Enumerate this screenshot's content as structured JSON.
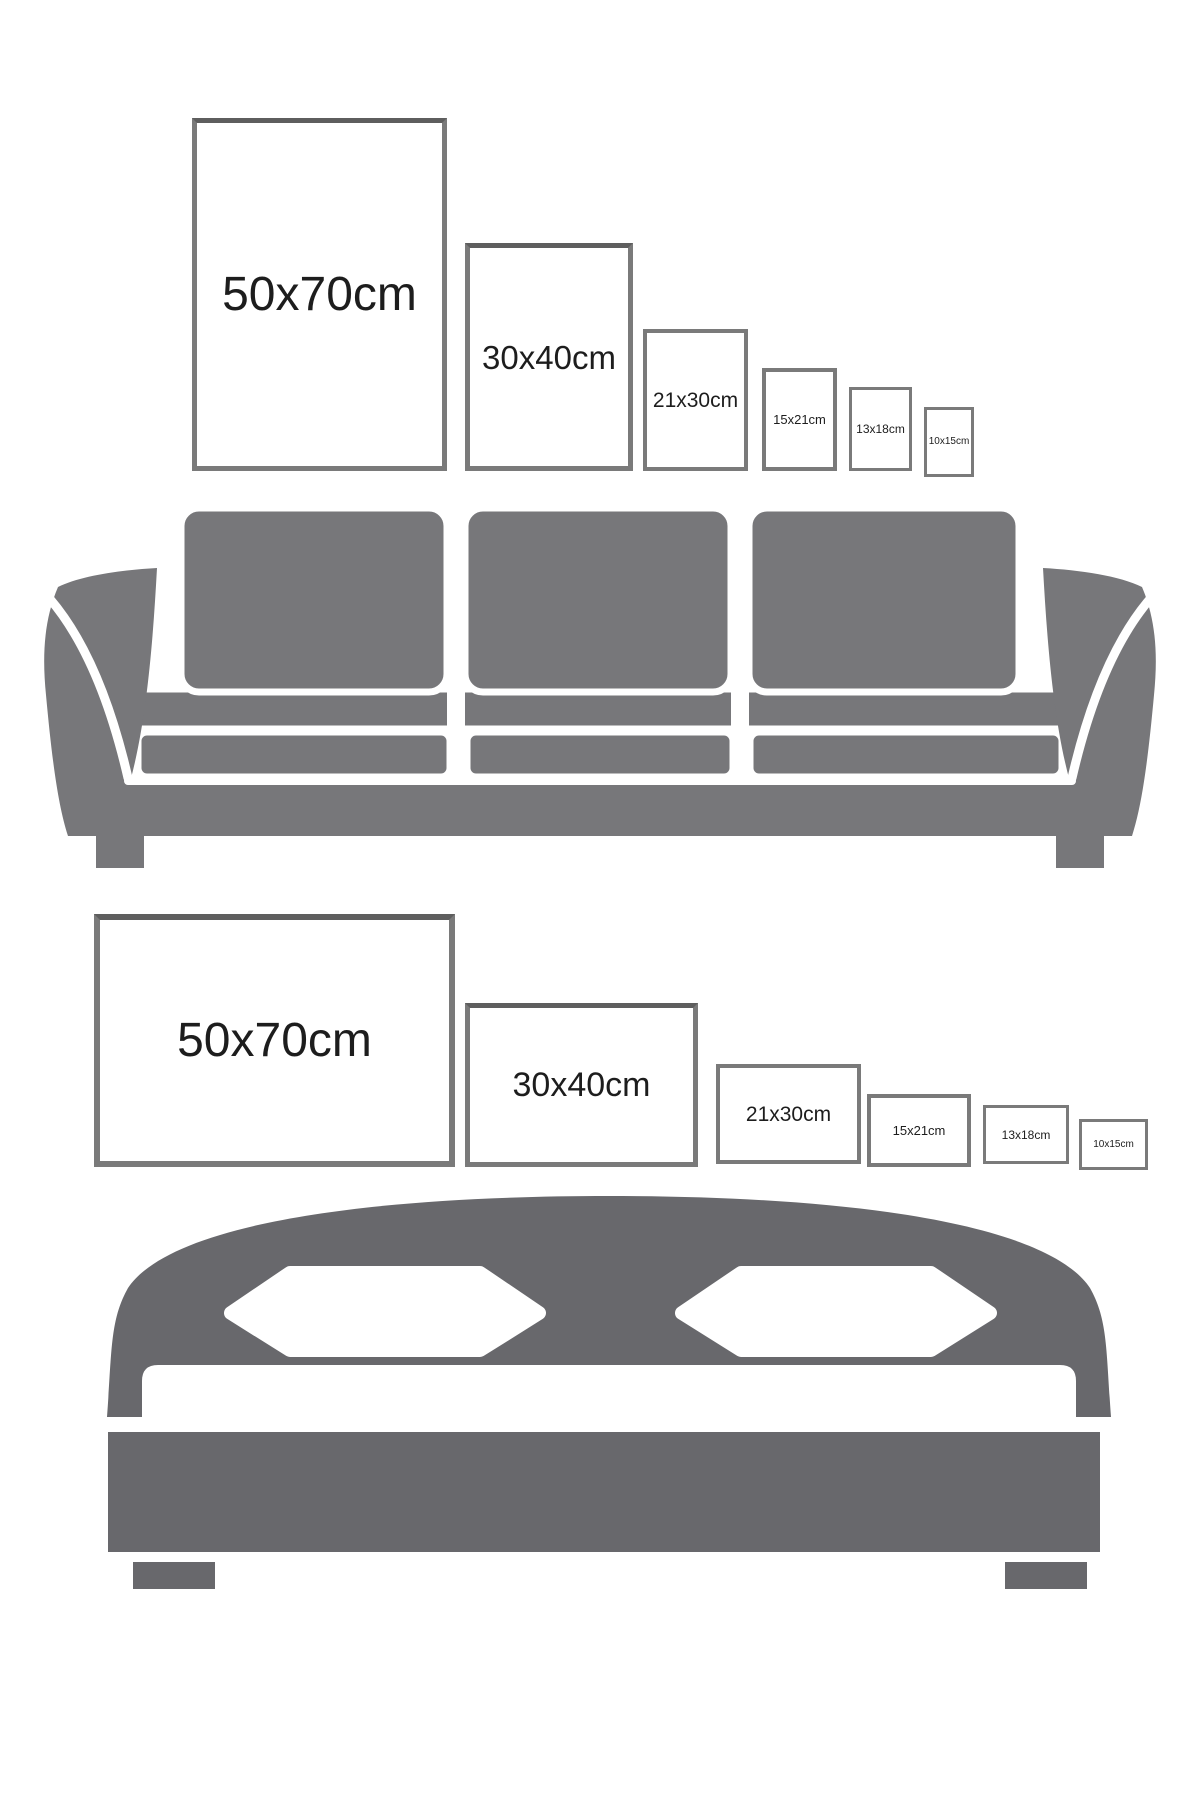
{
  "page": {
    "background": "#ffffff",
    "width": 1200,
    "height": 1800
  },
  "colors": {
    "frame_border": "#7a7a7a",
    "frame_border_top_large": "#5e5e5e",
    "label_text": "#1d1d1d",
    "sofa_gray": "#77777a",
    "bed_gray": "#68686c",
    "separator_white": "#ffffff"
  },
  "portrait_row": {
    "description": "portrait poster sizes above sofa",
    "frames": [
      {
        "id": "50x70-portrait",
        "label": "50x70cm",
        "x": 192,
        "y": 118,
        "w": 255,
        "h": 353,
        "border_px": 5,
        "font_px": 48,
        "dark_top": true
      },
      {
        "id": "30x40-portrait",
        "label": "30x40cm",
        "x": 465,
        "y": 243,
        "w": 168,
        "h": 228,
        "border_px": 5,
        "font_px": 33,
        "dark_top": true
      },
      {
        "id": "21x30-portrait",
        "label": "21x30cm",
        "x": 643,
        "y": 329,
        "w": 105,
        "h": 142,
        "border_px": 4,
        "font_px": 21,
        "dark_top": false
      },
      {
        "id": "15x21-portrait",
        "label": "15x21cm",
        "x": 762,
        "y": 368,
        "w": 75,
        "h": 103,
        "border_px": 4,
        "font_px": 13,
        "dark_top": false
      },
      {
        "id": "13x18-portrait",
        "label": "13x18cm",
        "x": 849,
        "y": 387,
        "w": 63,
        "h": 84,
        "border_px": 3,
        "font_px": 12,
        "dark_top": false
      },
      {
        "id": "10x15-portrait",
        "label": "10x15cm",
        "x": 924,
        "y": 407,
        "w": 50,
        "h": 70,
        "border_px": 3,
        "font_px": 10,
        "dark_top": false
      }
    ]
  },
  "landscape_row": {
    "description": "landscape poster sizes above bed",
    "frames": [
      {
        "id": "50x70-landscape",
        "label": "50x70cm",
        "x": 94,
        "y": 914,
        "w": 361,
        "h": 253,
        "border_px": 6,
        "font_px": 48,
        "dark_top": true
      },
      {
        "id": "30x40-landscape",
        "label": "30x40cm",
        "x": 465,
        "y": 1003,
        "w": 233,
        "h": 164,
        "border_px": 5,
        "font_px": 34,
        "dark_top": true
      },
      {
        "id": "21x30-landscape",
        "label": "21x30cm",
        "x": 716,
        "y": 1064,
        "w": 145,
        "h": 100,
        "border_px": 4,
        "font_px": 21,
        "dark_top": false
      },
      {
        "id": "15x21-landscape",
        "label": "15x21cm",
        "x": 867,
        "y": 1094,
        "w": 104,
        "h": 73,
        "border_px": 4,
        "font_px": 13,
        "dark_top": false
      },
      {
        "id": "13x18-landscape",
        "label": "13x18cm",
        "x": 983,
        "y": 1105,
        "w": 86,
        "h": 59,
        "border_px": 3,
        "font_px": 12,
        "dark_top": false
      },
      {
        "id": "10x15-landscape",
        "label": "10x15cm",
        "x": 1079,
        "y": 1119,
        "w": 69,
        "h": 51,
        "border_px": 3,
        "font_px": 10,
        "dark_top": false
      }
    ]
  },
  "icons": {
    "sofa": "sofa-silhouette",
    "bed": "bed-silhouette"
  }
}
